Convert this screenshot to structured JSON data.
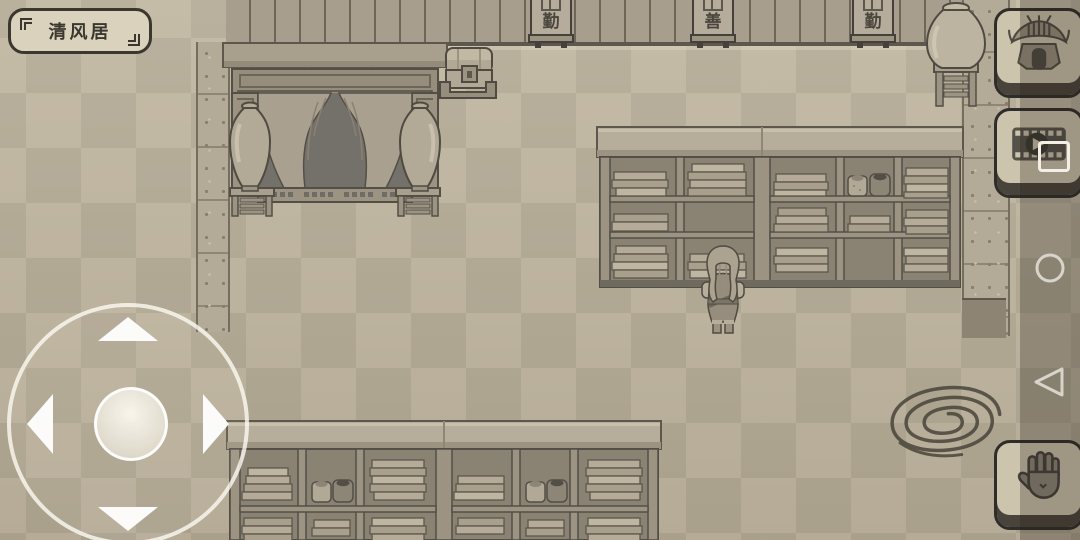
{
  "hud": {
    "location_label": "清风居",
    "buttons": {
      "home": {
        "icon": "pavilion-icon"
      },
      "video": {
        "icon": "film-play-icon"
      },
      "interact": {
        "icon": "hand-icon"
      }
    },
    "joystick": {
      "directions": [
        "up",
        "left",
        "right",
        "down"
      ]
    }
  },
  "scene": {
    "wall_scrolls": [
      {
        "char": "勤"
      },
      {
        "char": "善"
      },
      {
        "char": "勤"
      }
    ],
    "objects": [
      "canopy-bed",
      "vases",
      "chest",
      "bookshelves",
      "jars",
      "player-character",
      "ink-swirl"
    ]
  },
  "android_nav": {
    "home": "circle-outline",
    "back": "triangle-left-outline"
  },
  "icons": {
    "pavilion-icon": "chinese-pavilion-line-art",
    "film-play-icon": "filmstrip-with-play-circle",
    "hand-icon": "open-palm",
    "home-icon": "circle-outline",
    "back-icon": "triangle-left-outline",
    "joystick-arrows": "four-white-triangles",
    "ink-swirl": "brush-spiral"
  },
  "colors": {
    "floor_light": "#bdb39e",
    "floor_dark": "#b0a792",
    "wall": "#a79e8e",
    "outline": "#534f47",
    "button_face": "#cdc4ae",
    "overlay": "rgba(38,33,26,0.28)",
    "ink": "#49443a",
    "nav_icon": "#d8d4ca"
  }
}
